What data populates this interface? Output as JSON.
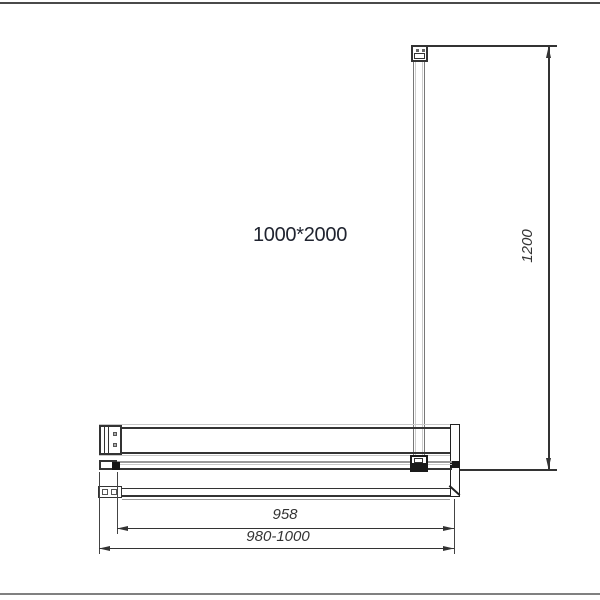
{
  "labels": {
    "panel_size": "1000*2000",
    "glass_width": "958",
    "total_width_range": "980-1000",
    "support_bar_length": "1200"
  },
  "colors": {
    "line_dark": "#333333",
    "line_gray": "#999999",
    "line_light": "#c8c8c8",
    "frame_top": "#4a4a4a",
    "frame_bottom": "#808080",
    "label_text": "#202430",
    "clamp_fill": "#1a1a1a"
  }
}
